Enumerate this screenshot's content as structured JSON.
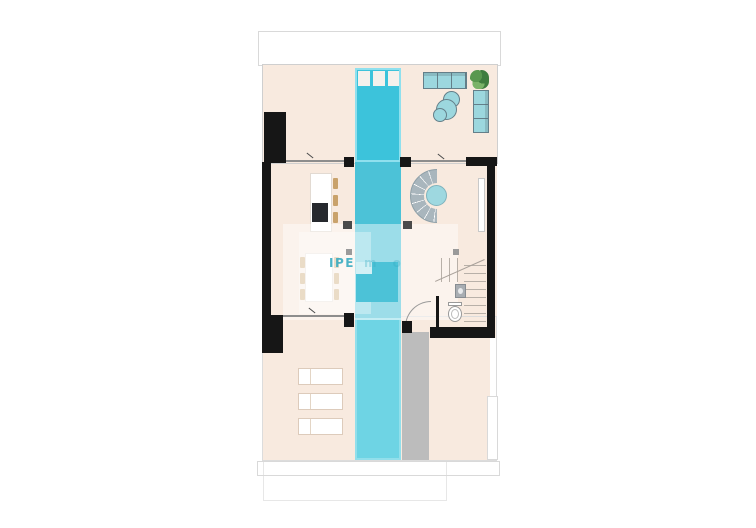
{
  "watermark": {
    "strong": "IPE",
    "faint": "m o"
  },
  "colors": {
    "floor": "#f8eadf",
    "pool_top": "#3cc3db",
    "pool_mid": "#4cc2d7",
    "pool_low": "#6ed4e4",
    "pool_rim": "#8fe0ee",
    "wall": "#161616",
    "walkway": "#bcbcbc",
    "sofa_teal": "#9cd7de",
    "sofa_border": "#647f89",
    "tan": "#c9a26b",
    "cooktop": "#26292e",
    "fixture": "#a8adb2",
    "plant_dark": "#3f7d3f",
    "plant_mid": "#59984f",
    "plant_light": "#7ab368",
    "outline": "#d9d9d9",
    "line": "#8d8d8d",
    "stairline": "#b8b0a8",
    "wm_teal": "#2fa8bf",
    "step": "#f5f1ec"
  }
}
